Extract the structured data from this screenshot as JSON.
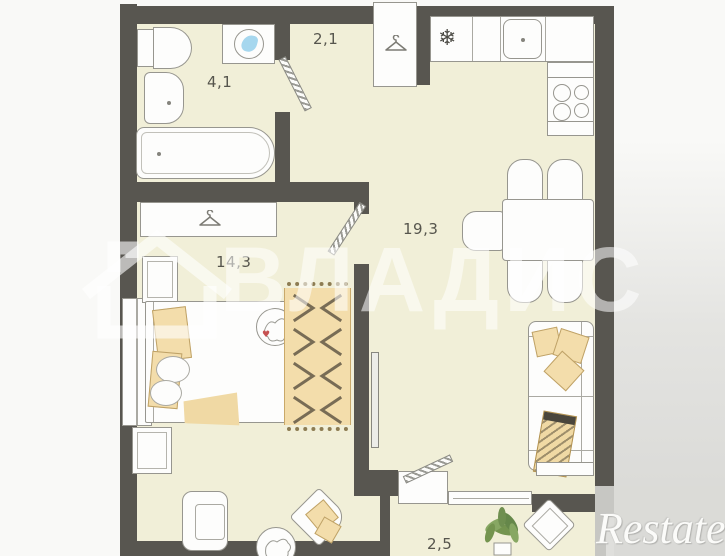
{
  "plan": {
    "wall_color": "#585650",
    "floor_color": "#f1efd8",
    "accent_beige": "#f3ddab",
    "furniture_outline": "#97968f",
    "label_color": "#56554d",
    "plant_green": "#74944f",
    "water_blue": "#a6d7ee",
    "page_background": "#f9f9f7",
    "corner_shade": "#d7d7d4",
    "rooms": [
      {
        "name": "bathroom",
        "area_label": "4,1"
      },
      {
        "name": "hallway",
        "area_label": "2,1"
      },
      {
        "name": "bedroom",
        "area_label": "14,3"
      },
      {
        "name": "kitchen-living-room",
        "area_label": "19,3"
      },
      {
        "name": "balcony",
        "area_label": "2,5"
      }
    ],
    "icons": {
      "snowflake": "❄",
      "heart": "♥"
    }
  },
  "watermarks": {
    "center_brand": "ВЛАДИС",
    "corner_brand": "Restate"
  }
}
